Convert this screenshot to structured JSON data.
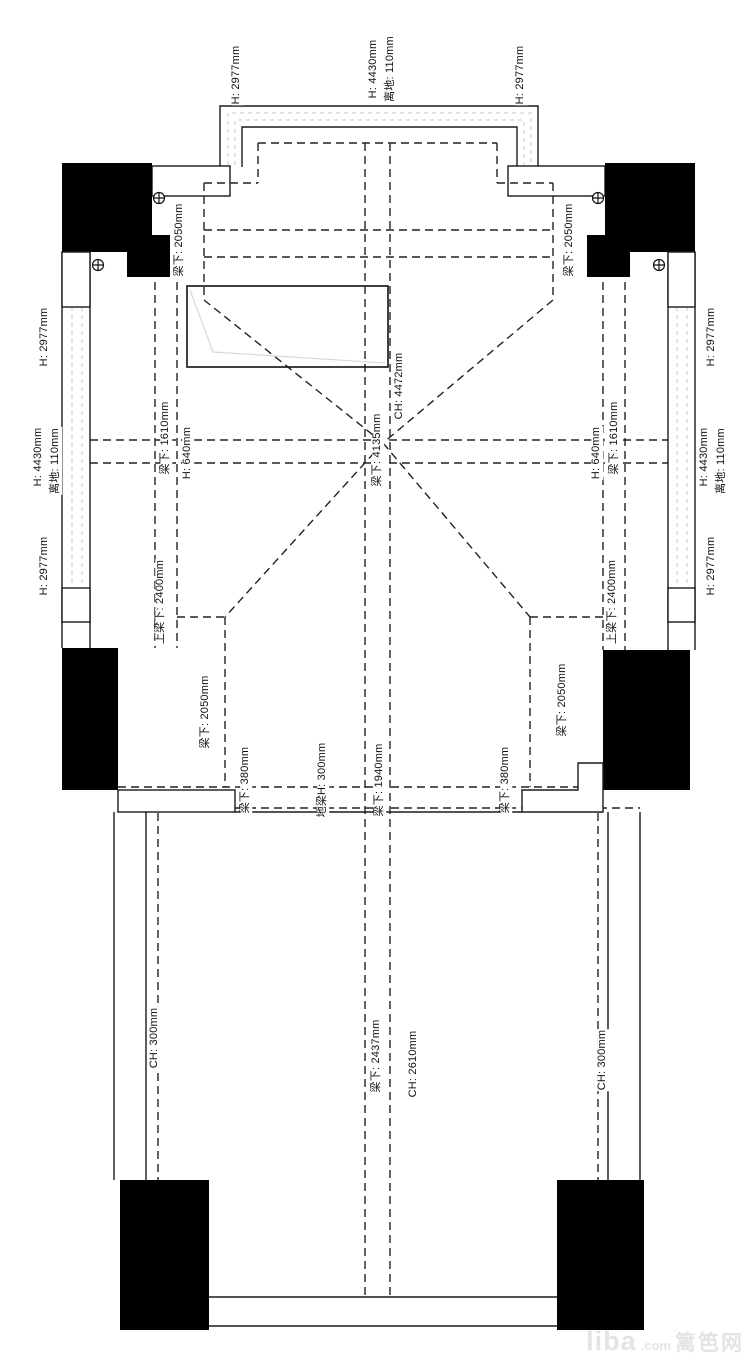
{
  "title": "ceiling-beam-height-floor-plan",
  "colors": {
    "line": "#1a1a1a",
    "dashed_dark": "#222222",
    "dashed_light": "#c9c9c9",
    "block_fill": "#000000",
    "watermark": "#e4e4e4"
  },
  "labels": {
    "t_h_left": "H: 2977mm",
    "t_h_mid": "H: 4430mm",
    "t_ground_mid": "离地: 110mm",
    "t_h_right": "H: 2977mm",
    "lw_h_top": "H: 2977mm",
    "lw_h_mid": "H: 4430mm",
    "lw_ground_mid": "离地: 110mm",
    "lw_h_bot": "H: 2977mm",
    "rw_h_top": "H: 2977mm",
    "rw_h_mid": "H: 4430mm",
    "rw_ground_mid": "离地: 110mm",
    "rw_h_bot": "H: 2977mm",
    "beam_tl_2050": "梁下: 2050mm",
    "beam_tr_2050": "梁下: 2050mm",
    "ch_4472": "CH: 4472mm",
    "beam_4135": "梁下: 4135mm",
    "beam_l_1610": "梁下: 1610mm",
    "h_l_640": "H: 640mm",
    "h_r_640": "H: 640mm",
    "beam_r_1610": "梁下: 1610mm",
    "upper_beam_l_2400": "上梁下: 2400mm",
    "upper_beam_r_2400": "上梁下: 2400mm",
    "beam_bl_2050": "梁下: 2050mm",
    "beam_br_2050": "梁下: 2050mm",
    "beam_bl_380": "梁下: 380mm",
    "floor_beam_300": "地梁H: 300mm",
    "beam_1940": "梁下: 1940mm",
    "beam_br_380": "梁下: 380mm",
    "ch_l_300": "CH: 300mm",
    "beam_2437": "梁下: 2437mm",
    "ch_2610": "CH: 2610mm",
    "ch_r_300": "CH: 300mm"
  },
  "watermark": {
    "liba": "liba",
    "com": ".com",
    "cn": "篱笆网"
  }
}
